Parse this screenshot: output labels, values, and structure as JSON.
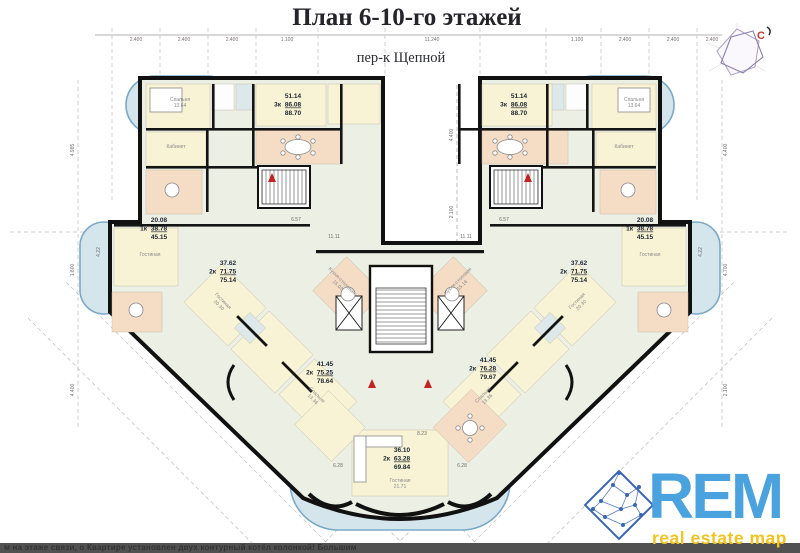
{
  "header": {
    "title": "План 6-10-го этажей",
    "subtitle": "пер-к Щепной"
  },
  "compass": {
    "north": "С"
  },
  "dims": {
    "top": [
      "2.400",
      "2.400",
      "2.400",
      "1.100",
      "11.240",
      "1.100",
      "2.400",
      "2.400",
      "2.400"
    ],
    "left": [
      "4.985",
      "1.800",
      "4.400"
    ],
    "right": [
      "4.400",
      "4.700",
      "2.100"
    ],
    "gap": [
      "4.400",
      "2.100"
    ],
    "inner": {
      "corr": "11.11",
      "hall": "6.57",
      "bay": "6.28",
      "bay_c": "8.23",
      "pod": "4.22"
    }
  },
  "apartments": {
    "left3k": {
      "t": "3к",
      "a1": "51.14",
      "a2": "86.08",
      "a3": "88.70"
    },
    "right3k": {
      "t": "3к",
      "a1": "51.14",
      "a2": "86.08",
      "a3": "88.70"
    },
    "left1k": {
      "t": "1к",
      "a1": "20.08",
      "a2": "38.78",
      "a3": "45.15"
    },
    "right1k": {
      "t": "1к",
      "a1": "20.08",
      "a2": "38.78",
      "a3": "45.15"
    },
    "left2k": {
      "t": "2к",
      "a1": "37.62",
      "a2": "71.75",
      "a3": "75.14"
    },
    "right2k": {
      "t": "2к",
      "a1": "37.62",
      "a2": "71.75",
      "a3": "75.14"
    },
    "left2kLow": {
      "t": "2к",
      "a1": "41.45",
      "a2": "75.25",
      "a3": "78.64"
    },
    "right2kLow": {
      "t": "2к",
      "a1": "41.45",
      "a2": "76.28",
      "a3": "79.67"
    },
    "bottom2k": {
      "t": "2к",
      "a1": "36.10",
      "a2": "63.28",
      "a3": "69.84"
    }
  },
  "rooms": {
    "bedroom": "Спальня",
    "bedroom_area_top": "13.64",
    "bedroom_area_diag": "13.36",
    "study": "Кабинет",
    "living": "Гостиная",
    "living_area_diag": "20.30",
    "living_area_bottom": "21.71",
    "kitchen_dining": "Кухня-столовая",
    "kitchen_dining_area_l": "15.02",
    "kitchen_dining_area_r": "15.16"
  },
  "logo": {
    "name": "REM",
    "tagline": "real estate map"
  },
  "footer": {
    "text": "м на этаже связи, о Квартире установлен двух контурный котёл колонкой! Большим"
  },
  "colors": {
    "wall": "#111111",
    "room_cream": "#f8f3d4",
    "room_peach": "#f5dcc5",
    "room_blue": "#dde8ea",
    "balcony_stroke": "#7aa9c9",
    "balcony_fill": "#d5e5ec",
    "logo_blue": "#4aa2df",
    "logo_yellow": "#f1c41f",
    "north_red": "#c0392b"
  }
}
